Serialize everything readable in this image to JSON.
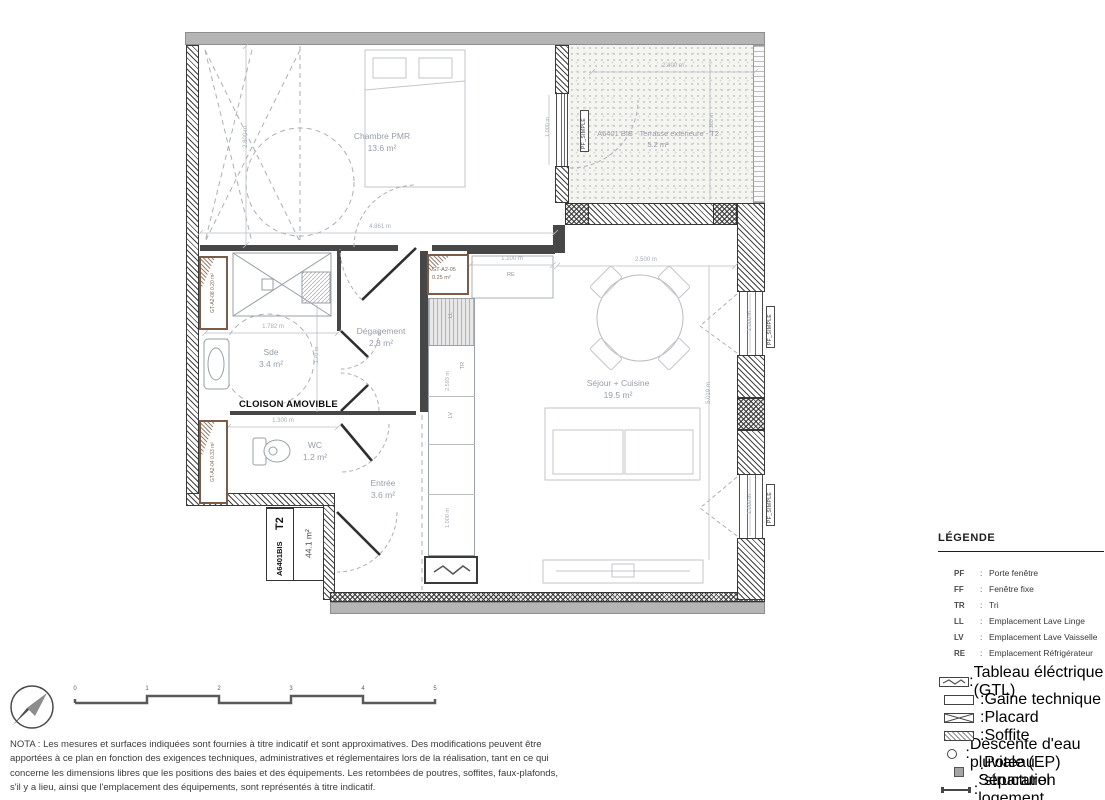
{
  "plan": {
    "rooms": {
      "chambre": {
        "name": "Chambre PMR",
        "area": "13.6 m²"
      },
      "terrasse": {
        "name": "A6401 BIS - Terrasse extérieure - T2",
        "area": "5.2 m²"
      },
      "degagement": {
        "name": "Dégagement",
        "area": "2.8 m²"
      },
      "sde": {
        "name": "Sde",
        "area": "3.4 m²"
      },
      "wc": {
        "name": "WC",
        "area": "1.2 m²"
      },
      "entree": {
        "name": "Entrée",
        "area": "3.6 m²"
      },
      "sejour": {
        "name": "Séjour + Cuisine",
        "area": "19.5 m²"
      }
    },
    "cloison": "CLOISON AMOVIBLE",
    "title_block": {
      "lot": "A6401",
      "bis": "BIS",
      "type": "T2",
      "area": "44.1 m²"
    },
    "gaines": {
      "gt08": {
        "code": "GT-A2-08",
        "area": "0.20 m²"
      },
      "gt04": {
        "code": "GT-A2-04",
        "area": "0.33 m²"
      },
      "gt05": {
        "code": "GT-A2-05",
        "area": "0.25 m²"
      }
    },
    "window_tag": "PF_SIMPLE",
    "appliances": {
      "ll": "LL",
      "tr": "TR",
      "lv": "LV",
      "re": "RE"
    },
    "dims": {
      "chambre_w": "4.861 m",
      "chambre_h": "2.800 m",
      "win": "1.000 m",
      "terrasse_w": "2.400 m",
      "terrasse_h": "2.180 m",
      "sde_w": "1.782 m",
      "sde_h": "1.70 m",
      "wc_w": "1.300 m",
      "re_w": "1.100 m",
      "sejour_w": "2.500 m",
      "sejour_h": "5.019 m",
      "kitchen_h": "2.593 m"
    }
  },
  "legend": {
    "title": "LÉGENDE",
    "sep": ":",
    "abbrevs": [
      {
        "code": "PF",
        "desc": "Porte fenêtre"
      },
      {
        "code": "FF",
        "desc": "Fenêtre fixe"
      },
      {
        "code": "TR",
        "desc": "Tri"
      },
      {
        "code": "LL",
        "desc": "Emplacement Lave Linge"
      },
      {
        "code": "LV",
        "desc": "Emplacement Lave Vaisselle"
      },
      {
        "code": "RE",
        "desc": "Emplacement Réfrigérateur"
      }
    ],
    "symbols": [
      {
        "icon": "gtl-panel-icon",
        "desc": "Tableau éléctrique (GTL)"
      },
      {
        "icon": "gaine-technique-icon",
        "desc": "Gaine technique"
      },
      {
        "icon": "placard-icon",
        "desc": "Placard"
      },
      {
        "icon": "soffite-icon",
        "desc": "Soffite"
      },
      {
        "icon": "descente-eau-icon",
        "desc": "Descente d'eau pluviale (EP)"
      },
      {
        "icon": "poteau-structurel-icon",
        "desc": "Poteau structurel"
      },
      {
        "icon": "separation-logement-icon",
        "desc": "Séparation logement"
      }
    ]
  },
  "scalebar": {
    "ticks": [
      "0",
      "1",
      "2",
      "3",
      "4",
      "5"
    ]
  },
  "nota": "NOTA : Les mesures et surfaces indiquées sont fournies à titre indicatif et sont approximatives. Des modifications peuvent être\napportées à ce plan en fonction des exigences techniques, administratives et réglementaires lors de la réalisation, tant en ce qui\nconcerne les dimensions libres que les positions des baies et des équipements. Les retombées de poutres, soffites, faux-plafonds,\ns'il y a lieu, ainsi que l'emplacement des équipements, sont représentés à titre indicatif."
}
